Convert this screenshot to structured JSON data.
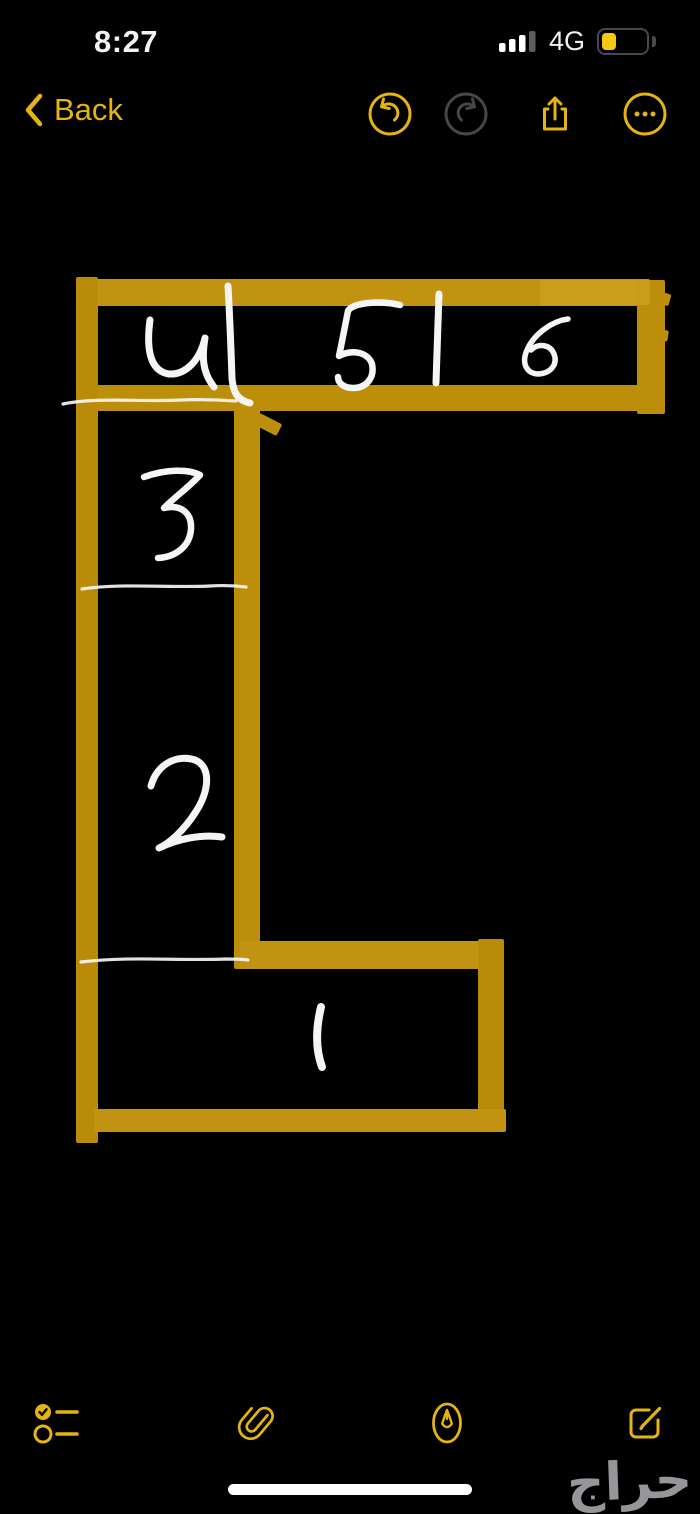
{
  "status_bar": {
    "time": "8:27",
    "network": "4G",
    "signal": {
      "bars_total": 4,
      "bars_active": 3,
      "heights": [
        9,
        13,
        17,
        21
      ]
    },
    "battery_level_percent": 33
  },
  "nav_bar": {
    "back_label": "Back",
    "icons": [
      "undo-icon",
      "redo-icon (disabled)",
      "share-icon",
      "more-icon"
    ]
  },
  "sketch": {
    "description": "hand-drawn floor-plan sketch in yellow marker with white numbered rooms",
    "marker_color": "#BD8E09",
    "ink_color": "#F5F5F5",
    "room_labels": [
      "1",
      "2",
      "3",
      "4",
      "5",
      "6"
    ],
    "bars": [
      {
        "name": "top-wall-top",
        "x": 78,
        "y": 279,
        "w": 572,
        "h": 27,
        "c": "#C29211"
      },
      {
        "name": "top-wall-right",
        "x": 637,
        "y": 280,
        "w": 28,
        "h": 134,
        "c": "#BD8E09"
      },
      {
        "name": "right-jag-1",
        "x": 658,
        "y": 291,
        "w": 14,
        "h": 12,
        "c": "#BD8E09",
        "rot": 15
      },
      {
        "name": "right-jag-2",
        "x": 657,
        "y": 329,
        "w": 12,
        "h": 11,
        "c": "#BD8E09",
        "rot": 8
      },
      {
        "name": "top-wall-bottom",
        "x": 95,
        "y": 385,
        "w": 566,
        "h": 26,
        "c": "#BD8E09"
      },
      {
        "name": "top-wall-highlight",
        "x": 540,
        "y": 280,
        "w": 110,
        "h": 25,
        "c": "#D9AE2B",
        "op": 0.45
      },
      {
        "name": "left-wall",
        "x": 76,
        "y": 277,
        "w": 22,
        "h": 866,
        "c": "#B98B09"
      },
      {
        "name": "inner-wall",
        "x": 234,
        "y": 407,
        "w": 26,
        "h": 562,
        "c": "#BD8E09"
      },
      {
        "name": "inner-wall-stub",
        "x": 252,
        "y": 409,
        "w": 34,
        "h": 13,
        "c": "#BD8E09",
        "rot": 27
      },
      {
        "name": "mid-wall",
        "x": 240,
        "y": 941,
        "w": 264,
        "h": 28,
        "c": "#C29211"
      },
      {
        "name": "right-wall-bottom",
        "x": 478,
        "y": 939,
        "w": 26,
        "h": 193,
        "c": "#B98B09"
      },
      {
        "name": "bottom-wall",
        "x": 94,
        "y": 1109,
        "w": 412,
        "h": 23,
        "c": "#C29211"
      }
    ],
    "strokes": [
      {
        "name": "digit-4",
        "label": "4",
        "w": 7,
        "d": "M150,320 C146,350 150,371 169,374 C186,375 200,360 205,338 C202,356 202,372 214,387"
      },
      {
        "name": "divider-left",
        "w": 7,
        "d": "M228,286 C230,320 231,350 232,378 C233,392 237,400 250,403"
      },
      {
        "name": "digit-5",
        "label": "5",
        "w": 6.5,
        "d": "M400,305 C378,300 352,303 348,311 C345,326 342,342 339,356 C352,349 368,352 372,364 C375,378 366,388 353,388 C344,388 338,383 338,377"
      },
      {
        "name": "divider-right",
        "w": 7,
        "d": "M439,294 C438,320 437,352 436,383"
      },
      {
        "name": "digit-6",
        "label": "6",
        "w": 5.5,
        "d": "M568,319 C552,321 534,334 527,350 C521,364 527,374 539,374 C551,373 558,364 554,354 C550,344 538,343 531,350"
      },
      {
        "name": "rule-top",
        "w": 3.2,
        "op": 0.92,
        "d": "M63,404 C95,397 140,402 180,400 C205,399 222,400 236,401"
      },
      {
        "name": "digit-3",
        "label": "3",
        "w": 6.5,
        "d": "M144,477 C166,469 189,469 200,475 C189,487 176,496 164,508 C181,504 192,513 191,529 C190,546 176,557 158,558"
      },
      {
        "name": "rule-mid",
        "w": 3.2,
        "op": 0.92,
        "d": "M82,589 C120,583 170,588 210,586 C225,585 238,586 246,587"
      },
      {
        "name": "digit-2",
        "label": "2",
        "w": 7,
        "d": "M151,786 C157,764 177,754 195,760 C212,767 209,792 195,813 C184,830 170,843 159,848 C177,839 201,834 222,837"
      },
      {
        "name": "rule-bottom",
        "w": 3.2,
        "op": 0.92,
        "d": "M81,962 C130,956 180,961 225,959 C234,959 242,959 248,960"
      },
      {
        "name": "digit-1",
        "label": "1",
        "w": 8,
        "d": "M321,1007 C316,1028 315,1048 322,1067"
      }
    ]
  },
  "toolbar": {
    "icons": [
      "checklist-icon",
      "paperclip-icon",
      "markup-pen-icon",
      "compose-icon"
    ]
  },
  "watermark": {
    "text": "حراج"
  },
  "colors": {
    "background": "#000000",
    "accent": "#E4B511",
    "disabled_icon": "#47474B",
    "marker": "#BD8E09",
    "ink": "#F5F5F5",
    "battery_fill": "#F5C813",
    "watermark": "#96969A",
    "signal_inactive": "#5E5E62"
  }
}
